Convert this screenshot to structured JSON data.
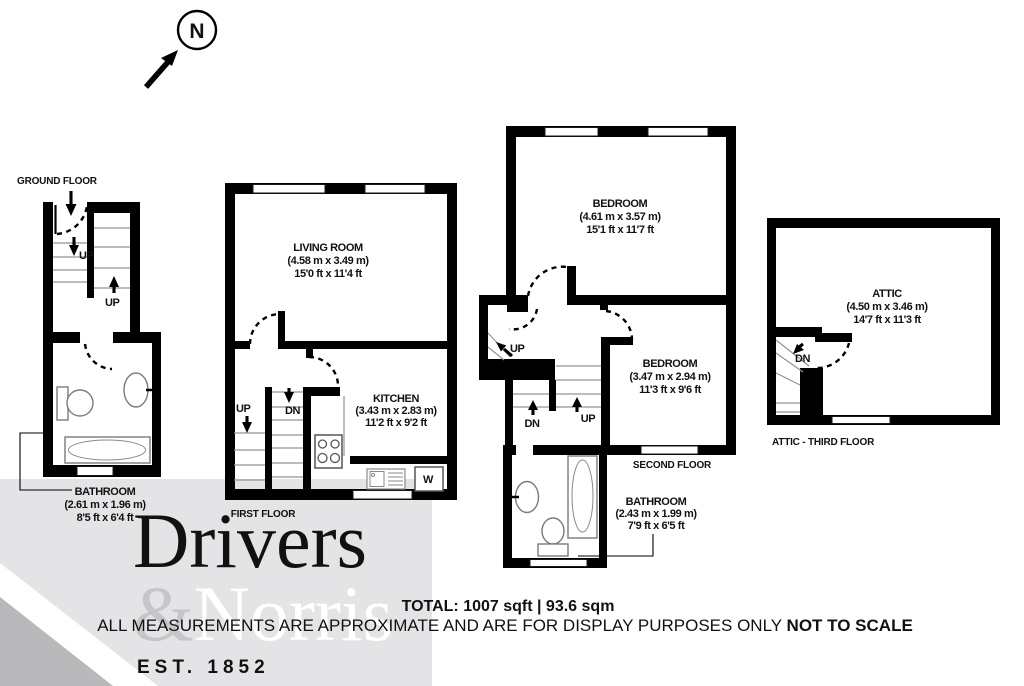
{
  "compass": {
    "label": "N"
  },
  "floors": {
    "ground": {
      "title": "GROUND FLOOR",
      "stairs_lower_label": "UP",
      "stairs_upper_label": "UP",
      "bathroom": {
        "name": "BATHROOM",
        "metric": "(2.61 m x 1.96 m)",
        "imperial": "8'5 ft x 6'4 ft"
      }
    },
    "first": {
      "title": "FIRST FLOOR",
      "stairs_up_label": "UP",
      "stairs_dn_label": "DN",
      "washer_label": "W",
      "living_room": {
        "name": "LIVING ROOM",
        "metric": "(4.58 m x 3.49 m)",
        "imperial": "15'0 ft x 11'4 ft"
      },
      "kitchen": {
        "name": "KITCHEN",
        "metric": "(3.43 m x 2.83 m)",
        "imperial": "11'2 ft x 9'2 ft"
      }
    },
    "second": {
      "title": "SECOND FLOOR",
      "stairs_attic_label": "UP",
      "stairs_dn_label": "DN",
      "stairs_up_label": "UP",
      "bedroom1": {
        "name": "BEDROOM",
        "metric": "(4.61 m x 3.57 m)",
        "imperial": "15'1 ft x 11'7 ft"
      },
      "bedroom2": {
        "name": "BEDROOM",
        "metric": "(3.47 m x 2.94 m)",
        "imperial": "11'3 ft x 9'6 ft"
      },
      "bathroom": {
        "name": "BATHROOM",
        "metric": "(2.43 m x 1.99 m)",
        "imperial": "7'9 ft x 6'5 ft"
      }
    },
    "attic": {
      "title": "ATTIC - THIRD FLOOR",
      "stairs_dn_label": "DN",
      "attic_room": {
        "name": "ATTIC",
        "metric": "(4.50 m x 3.46 m)",
        "imperial": "14'7 ft x 11'3 ft"
      }
    }
  },
  "watermark": {
    "word1": "Drivers",
    "amp": "&",
    "word2": "Norris",
    "est": "EST. 1852",
    "bg_color": "#e4e4e6",
    "corner_color": "#b9b9bb",
    "muted_color": "#c9c9cb"
  },
  "footer": {
    "total": "TOTAL: 1007 sqft | 93.6 sqm",
    "disclaimer_regular": "ALL MEASUREMENTS ARE APPROXIMATE AND ARE FOR DISPLAY PURPOSES ONLY ",
    "disclaimer_bold": "NOT TO SCALE"
  }
}
